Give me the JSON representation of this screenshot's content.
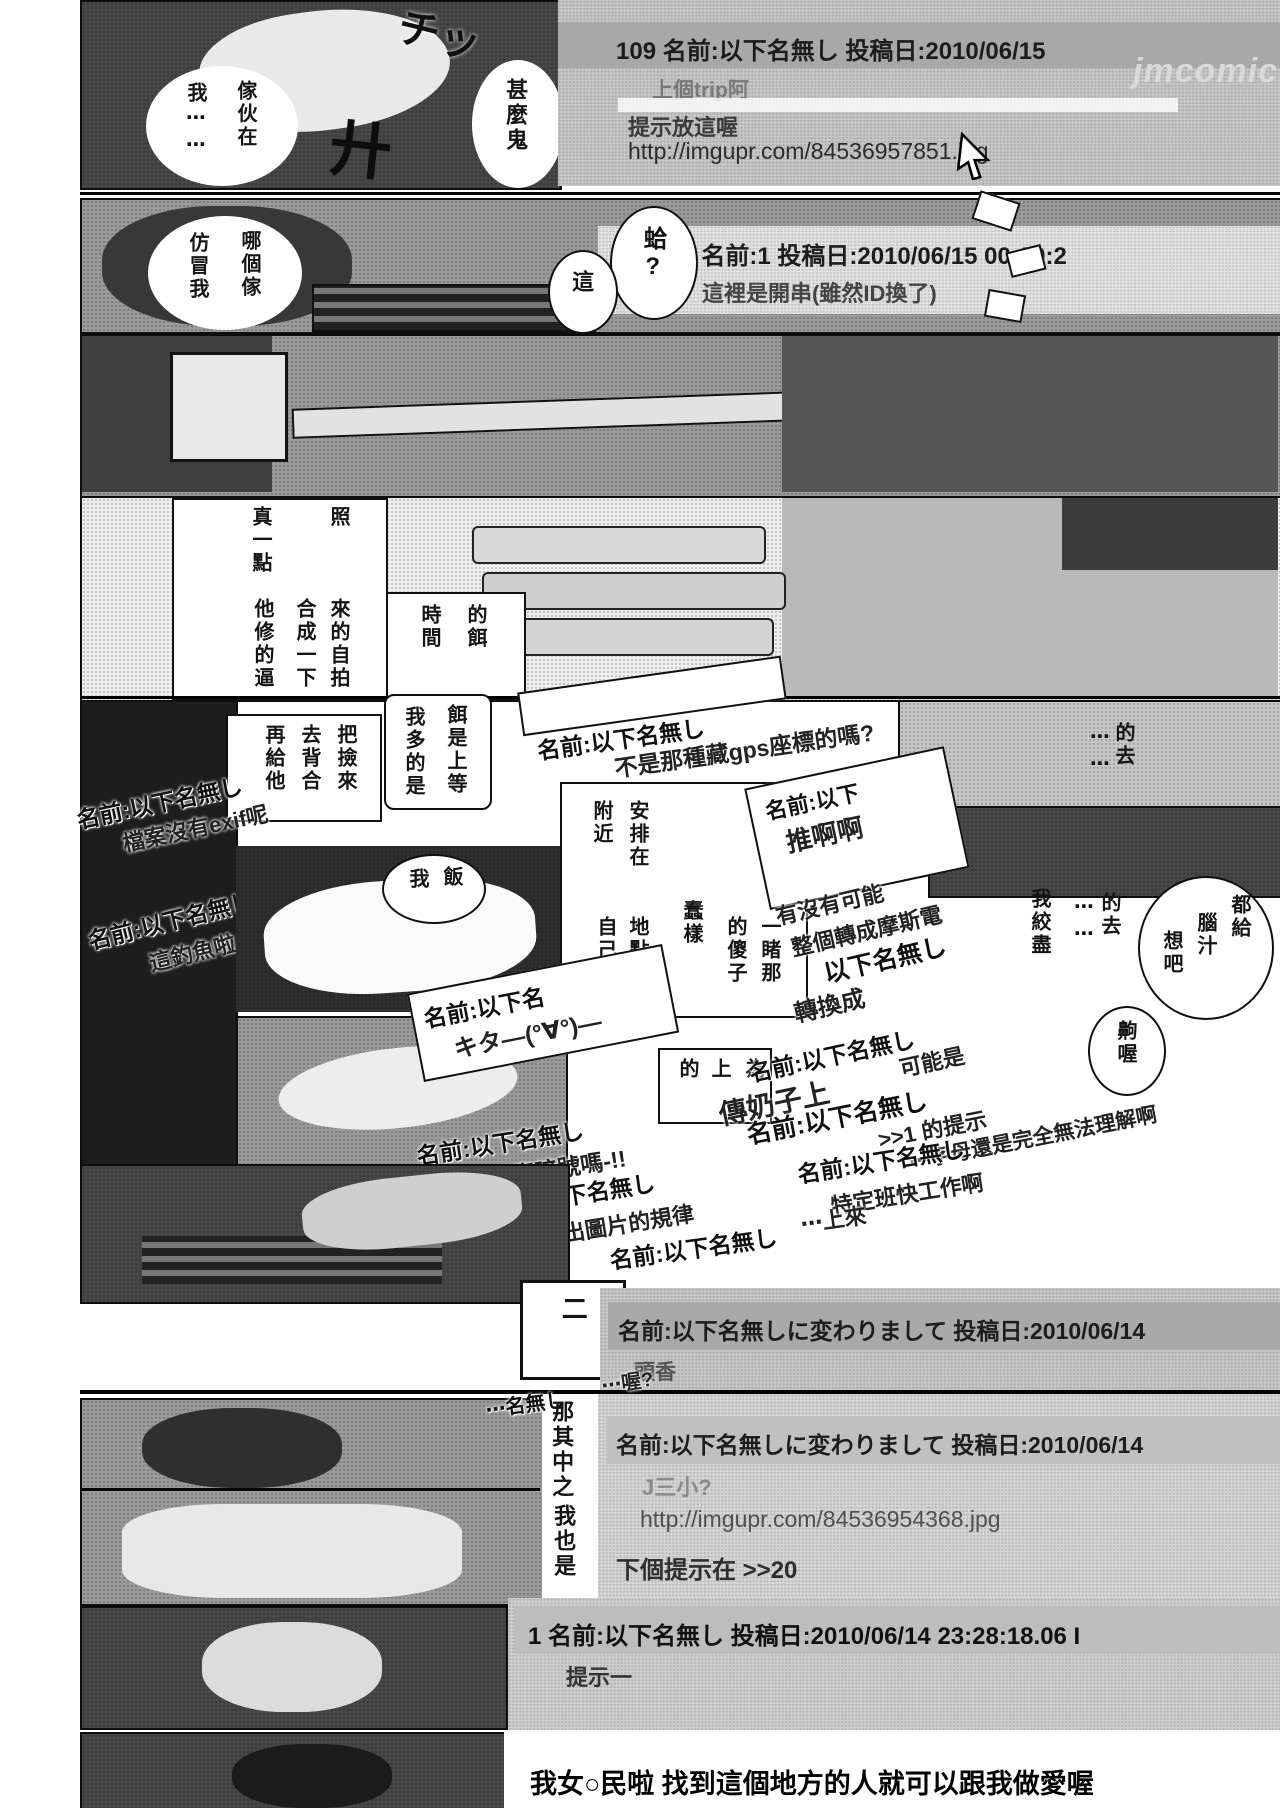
{
  "page": {
    "width": 1280,
    "height": 1808,
    "watermark": "jmcomic"
  },
  "colors": {
    "paper": "#ffffff",
    "ink": "#111111",
    "panel_gray": "#c7c7c7",
    "bar_gray": "#a8a8a8",
    "reply_gray": "#777777",
    "dark_text": "#222222"
  },
  "thread": {
    "post109": {
      "header": "109 名前:以下名無し  投稿日:2010/06/15",
      "reply": "上個trip阿",
      "hint_line": "提示放這喔",
      "url": "http://imgupr.com/84536957851.jpg"
    },
    "post108": {
      "header": "08 名前:1  投稿日:2010/06/15 00:00:2",
      "body": "這裡是開串(雖然ID換了)"
    },
    "kawa1": {
      "header": "名前:以下名無しに変わりまして  投稿日:2010/06/14",
      "body": "頭香"
    },
    "kawa2": {
      "header": "名前:以下名無しに変わりまして  投稿日:2010/06/14",
      "body": "J三小?",
      "url": "http://imgupr.com/84536954368.jpg",
      "hint": "下個提示在 >>20"
    },
    "post1": {
      "header": "1 名前:以下名無し  投稿日:2010/06/14 23:28:18.06 I",
      "body": "提示一",
      "partial": "84536954368.j",
      "opening": "我女○民啦 找到這個地方的人就可以跟我做愛喔"
    }
  },
  "floats": {
    "gps": {
      "name": "名前:以下名無し",
      "body": "不是那種藏gps座標的嗎?"
    },
    "exif": {
      "name": "名前:以下名無し",
      "body": "檔案沒有exif呢"
    },
    "fishing": {
      "name": "名前:以下名無し",
      "body": "這釣魚啦"
    },
    "push": {
      "name": "名前:以下",
      "body": "推啊啊"
    },
    "morse": {
      "line1": "有沒有可能",
      "line2": "整個轉成摩斯電",
      "name": "以下名無し",
      "line3": "轉換成"
    },
    "kita": {
      "name": "名前:以下名",
      "body": "キタ—(°∀°)—"
    },
    "oppai": {
      "name": "名前:以下名無し",
      "big": "傳奶子上",
      "body": "可能是"
    },
    "hint1": {
      "name": "名前:以下名無し",
      "body": ">>1 的提示"
    },
    "letters": "⋯字母還是完全無法理解啊",
    "angou": {
      "name": "名前:以下名無し",
      "body": "這是甚麼暗號嗎-!!"
    },
    "pattern": {
      "name": "名前:以下名無し",
      "body": "看不出圖片的規律"
    },
    "tokutei": {
      "name": "名前:以下名無し",
      "body": "特定班快工作啊"
    },
    "raise": {
      "name": "名前:以下名無し",
      "frag": "⋯上來"
    },
    "endfrag": {
      "name": "⋯名無し",
      "body": "⋯喔?"
    }
  },
  "bubbles": {
    "imposter1": [
      "傢伙在",
      "我⋯⋯"
    ],
    "imposter2": [
      "哪個傢",
      "仿冒我"
    ],
    "what": [
      "甚麼鬼"
    ],
    "ha": [
      "蛤?"
    ],
    "this": [
      "這"
    ],
    "rice": [
      "飯",
      "我"
    ],
    "bait_time": [
      "的餌",
      "時間"
    ],
    "bait_plenty": [
      "餌是上等",
      "我多的是"
    ],
    "think": [
      "都給",
      "腦汁",
      "想吧"
    ],
    "hmm": [
      "齁喔"
    ],
    "edge1": [
      "的去",
      "⋯⋯"
    ],
    "edge2": [
      "的去",
      "⋯⋯",
      "我絞盡"
    ]
  },
  "captions": {
    "photo_top": [
      "照",
      "真一點"
    ],
    "photo_bottom": [
      "來的自拍",
      "合成一下",
      "他修的逼"
    ],
    "cutout": [
      "把撿來",
      "去背合",
      "再給他"
    ],
    "plan": [
      "些",
      "安排在",
      "附近",
      "一睹那",
      "的傻子",
      "蠢樣",
      "地點就",
      "自己家"
    ],
    "covered": [
      "為",
      "上",
      "的"
    ],
    "naka": "那其中之",
    "metoo": "我也是",
    "two": "二"
  },
  "sfx": {
    "chi": "チッ",
    "cross": "廾"
  }
}
